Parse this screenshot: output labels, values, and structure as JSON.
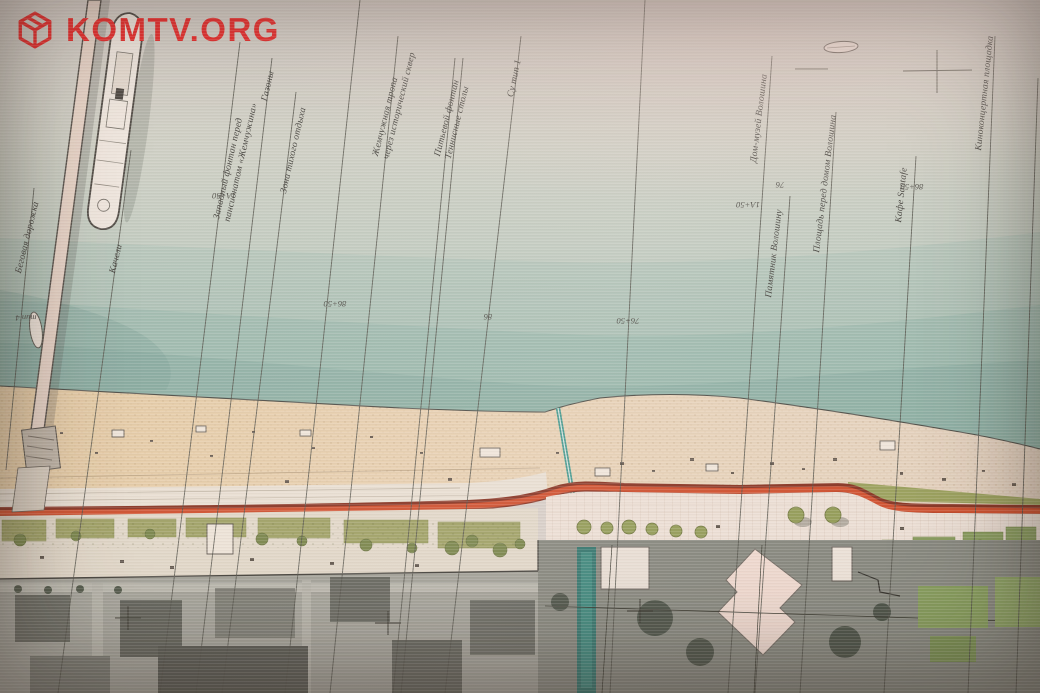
{
  "watermark": {
    "site": "KOMTV.ORG",
    "color": "#ee1b1d",
    "icon": "cube-logo-icon"
  },
  "plan": {
    "labels": [
      {
        "text": "Беговая дорожка"
      },
      {
        "text": "Качели"
      },
      {
        "text": "Западный фонтан перед\nпансионатом «Жемчужина»"
      },
      {
        "text": "Газоны"
      },
      {
        "text": "Зона тихого отдыха"
      },
      {
        "text": "Жемчужная тропа\nчерез исторический сквер"
      },
      {
        "text": "Питьевой фонтан\nТеннисные столы"
      },
      {
        "text": "Су тип 1"
      },
      {
        "text": "Дом-музей Волошина"
      },
      {
        "text": "Памятник Волошину"
      },
      {
        "text": "Площадь перед домом Волошина"
      },
      {
        "text": "Кафе Santafe"
      },
      {
        "text": "Киноконцертная площадка"
      }
    ],
    "stations": [
      {
        "text": "тип 4"
      },
      {
        "text": "1А+50"
      },
      {
        "text": "86+50"
      },
      {
        "text": "86"
      },
      {
        "text": "76+50"
      },
      {
        "text": "76"
      },
      {
        "text": "1А+50"
      },
      {
        "text": "86+50"
      }
    ],
    "colors": {
      "sea_deep": "#8fb9af",
      "sand": "#e9d2ac",
      "route_red": "#c84722",
      "photo_gray": "#8a9088"
    }
  }
}
